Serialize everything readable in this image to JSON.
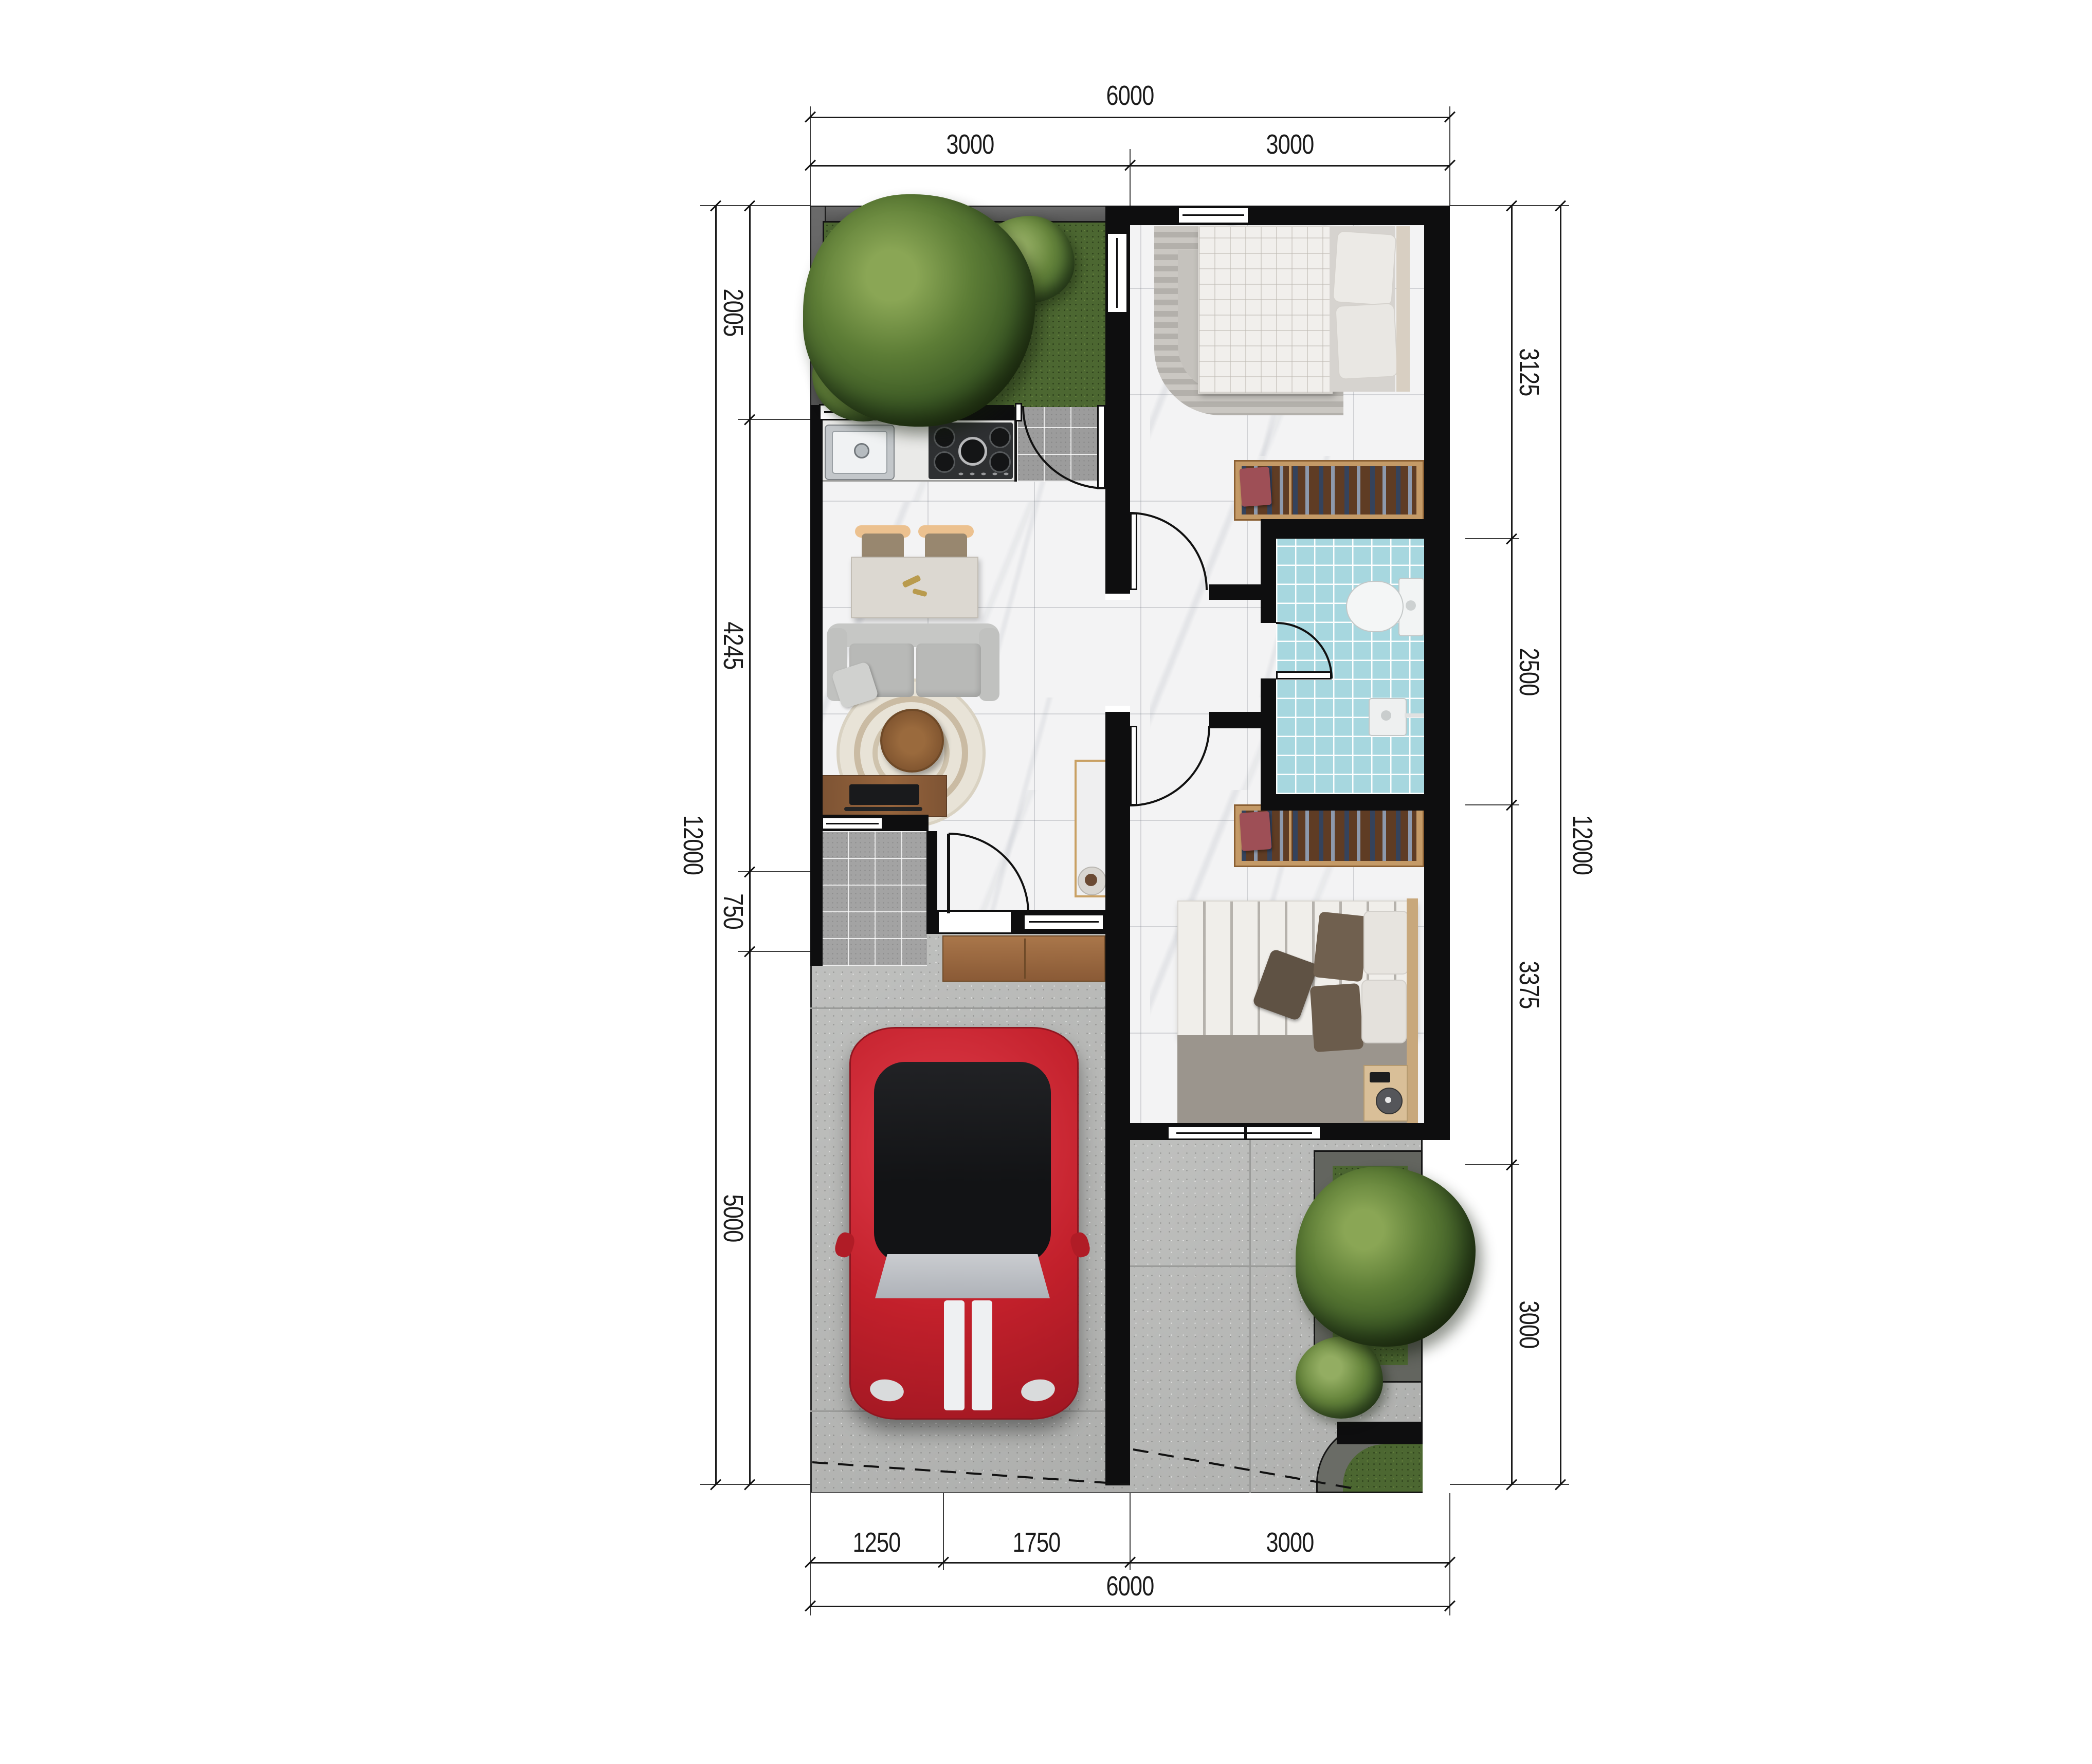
{
  "page": {
    "type": "architectural floor plan render (top view)",
    "units": "mm"
  },
  "dims": {
    "top": {
      "total": "6000",
      "segments": [
        "3000",
        "3000"
      ]
    },
    "bottom": {
      "total": "6000",
      "segments": [
        "1250",
        "1750",
        "3000"
      ]
    },
    "left": {
      "total": "12000",
      "segments": [
        "2005",
        "4245",
        "750",
        "5000"
      ]
    },
    "right": {
      "total": "12000",
      "segments": [
        "3125",
        "2500",
        "3375",
        "3000"
      ]
    }
  },
  "palette": {
    "wall": "#0e0e0f",
    "marble_floor": "#f3f3f4",
    "grass": "#4c6731",
    "bathroom_tile": "#a7d7df",
    "concrete": "#b8b9b7",
    "porch_tile": "#a3a3a3",
    "wood_dark": "#7e5434",
    "wood_light": "#c49a67",
    "car_red": "#c2202b",
    "dimension_text": "#1b1b1b"
  }
}
